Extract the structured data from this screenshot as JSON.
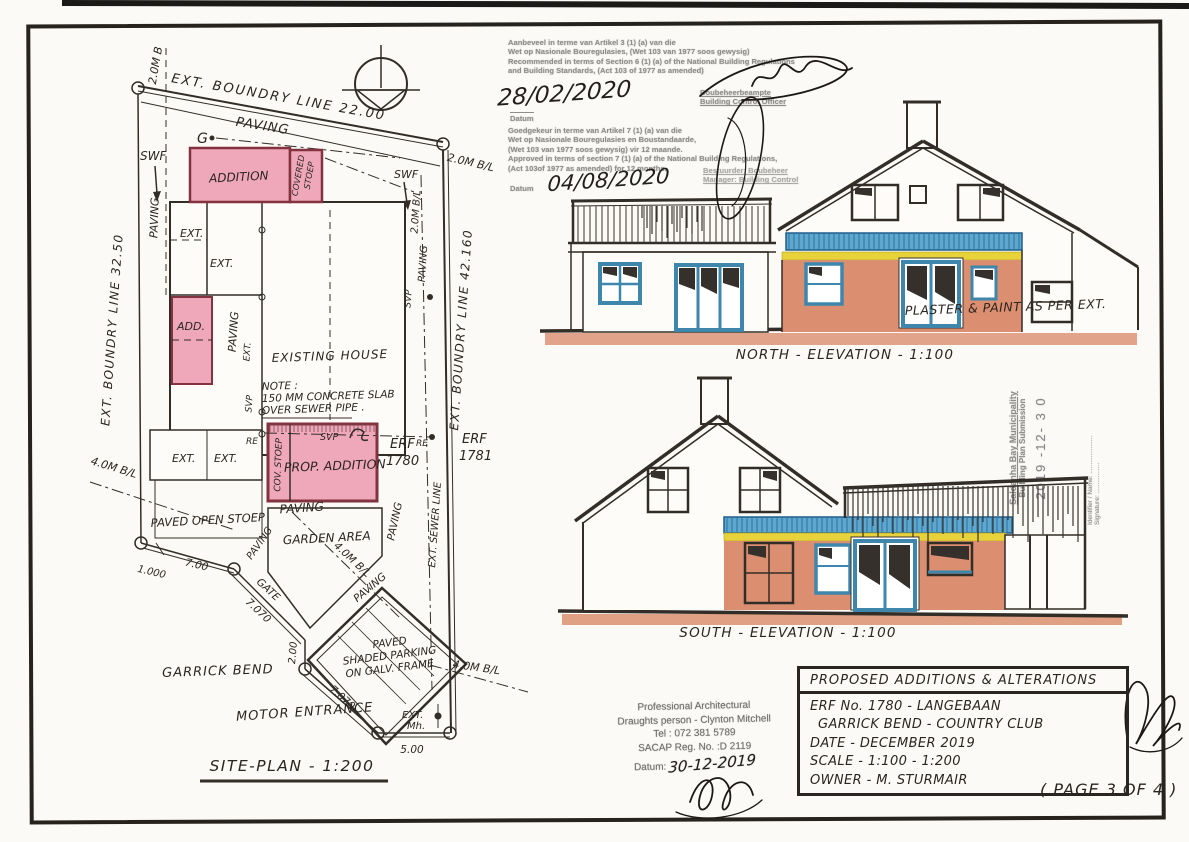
{
  "colors": {
    "pink": "#efa8ba",
    "pink_border": "#83333f",
    "terracotta": "#db8f70",
    "blue": "#5ea8cf",
    "yellow": "#e8d23c",
    "ink": "#2b2520",
    "stamp_gray": "#8f8e8c"
  },
  "site_plan": {
    "title": "SITE-PLAN - 1:200",
    "boundary_top": "EXT. BOUNDRY LINE 22.00",
    "boundary_left": "EXT. BOUNDRY LINE 32.50",
    "boundary_right": "EXT. BOUNDRY LINE 42.160",
    "street": "GARRICK BEND",
    "motor_entrance": "MOTOR ENTRANCE",
    "existing_house": "EXISTING HOUSE",
    "addition": "ADDITION",
    "covered_stoep_1": "COVERED",
    "covered_stoep_2": "STOEP",
    "add_small": "ADD.",
    "prop_addition": "PROP. ADDITION",
    "cov_stoep": "COV. STOEP",
    "paved_open_stoep": "PAVED OPEN STOEP",
    "garden_area": "GARDEN AREA",
    "parking_1": "PAVED",
    "parking_2": "SHADED PARKING",
    "parking_3": "ON GALV. FRAME",
    "paving": "PAVING",
    "ext": "EXT.",
    "ext_mh_1": "EXT.",
    "ext_mh_2": "Mh.",
    "ext_sewer": "EXT. SEWER LINE",
    "gate": "GATE",
    "erf_label": "ERF",
    "erf_1780": "1780",
    "erf_1781": "1781",
    "swf": "SWF",
    "g_marker": "G",
    "svp": "SVP",
    "re": "RE",
    "bl_20_top": "2.0M B",
    "bl_20": "2.0M B/L",
    "bl_40": "4.0M B/L",
    "note_1": "NOTE :",
    "note_2": "150 MM CONCRETE SLAB",
    "note_3": "OVER SEWER PIPE .",
    "dim_1000": "1.000",
    "dim_7_00": "7.00",
    "dim_7_070": "7.070",
    "dim_2_00": "2.00",
    "dim_5_00": "5.00"
  },
  "elevations": {
    "north_label": "NORTH - ELEVATION - 1:100",
    "south_label": "SOUTH - ELEVATION - 1:100",
    "plaster_note": "PLASTER & PAINT AS PER EXT."
  },
  "stamps": {
    "recommendation": {
      "lines": [
        "Aanbeveel in terme van Artikel 3 (1) (a) van die",
        "Wet op Nasionale Bouregulasies, (Wet 103 van 1977 soos gewysig)",
        "Recommended in terms of Section 6 (1) (a) of the National Building Regulations",
        "and Building Standards, (Act 103 of 1977 as amended)"
      ],
      "date_handwritten": "28/02/2020",
      "date_label": "Datum",
      "officer_line1": "Boubeheerbeampte",
      "officer_line2": "Building Control Officer"
    },
    "approval": {
      "lines": [
        "Goedgekeur in terme van Artikel 7 (1) (a) van die",
        "Wet op Nasionale Bouregulasies en Boustandaarde,",
        "(Wet 103 van 1977 soos gewysig) vir 12 maande.",
        "Approved in terms of section 7 (1) (a) of the National Building Regulations,",
        "(Act 103of 1977 as amended) for 12 months."
      ],
      "date_label": "Datum",
      "date_handwritten": "04/08/2020",
      "officer_line1": "Bestuurder: Boubeheer",
      "officer_line2": "Manager: Building Control"
    },
    "municipality": {
      "line1": "Saldanha Bay Municipality",
      "line2": "Building Plan Submission",
      "date_stamp": "2019 -12- 3 0",
      "name_label": "Identifier / Name: .....................",
      "signature_label": "Signature: ................."
    },
    "architect": {
      "line1": "Professional Architectural",
      "line2": "Draughts person - Clynton Mitchell",
      "line3": "Tel : 072 381 5789",
      "line4": "SACAP Reg. No. :D 2119",
      "datum_label": "Datum:",
      "datum_handwritten": "30-12-2019"
    }
  },
  "title_block": {
    "title": "PROPOSED ADDITIONS & ALTERATIONS",
    "erf_line": "ERF No. 1780 - LANGEBAAN",
    "location_line": "GARRICK BEND - COUNTRY CLUB",
    "date_line": "DATE - DECEMBER 2019",
    "scale_line": "SCALE - 1:100 - 1:200",
    "owner_line": "OWNER - M. STURMAIR",
    "page_note": "( PAGE 3 OF 4 )"
  }
}
